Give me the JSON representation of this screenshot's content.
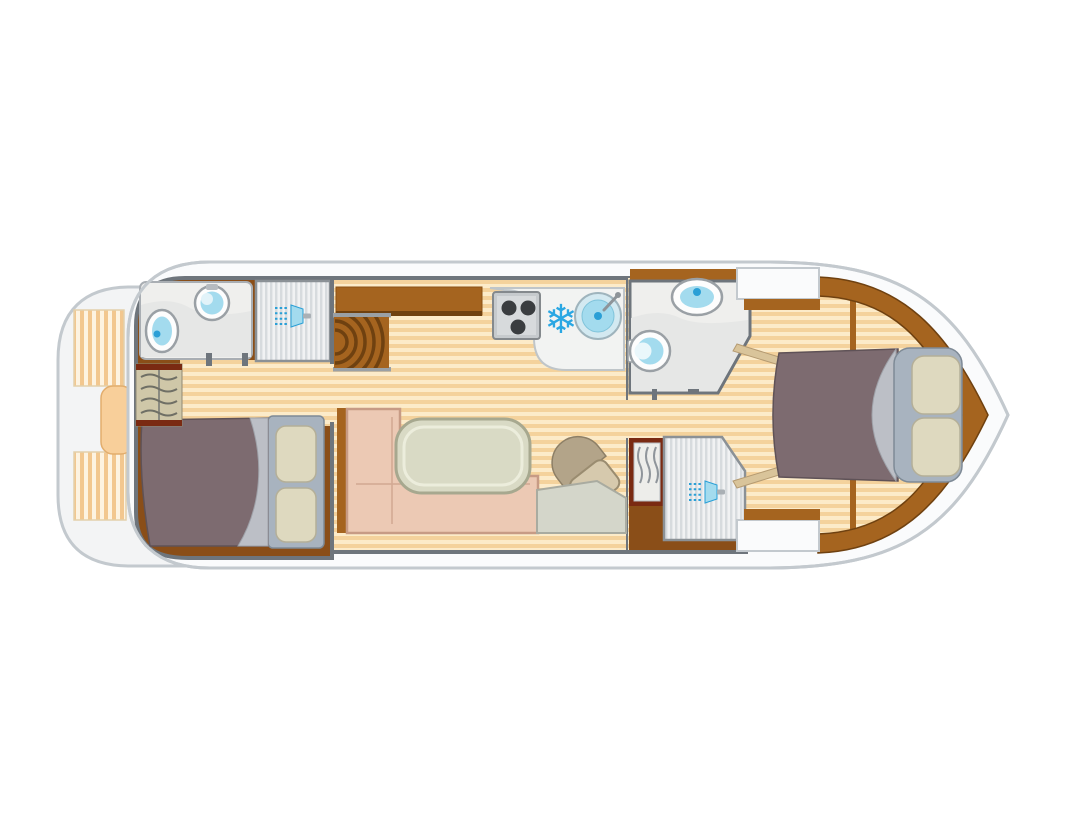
{
  "canvas": {
    "width": 1092,
    "height": 819,
    "background": "#ffffff"
  },
  "icons": {
    "fridge_glyph": "❄"
  },
  "colors": {
    "wall": "#6e757c",
    "hull_fill": "#fafbfc",
    "hull_stroke": "#c3c9ce",
    "deck_fill": "#f3f4f5",
    "floor_light": "#fcebc9",
    "floor_dark": "#f4d29c",
    "bench_light": "#fdf3e1",
    "bench_dark": "#f2c78f",
    "stern_table": "#f8cf9a",
    "wood": "#a5641f",
    "wood_dark": "#6f4110",
    "cabin_floor": "#8a4e18",
    "trim_red": "#7a2a12",
    "wardrobe": "#cfc7a8",
    "bath_floor": "#efefed",
    "bath_counter": "#e6e7e6",
    "shower_light": "#f1f2f3",
    "shower_dark": "#d7dbde",
    "fixture_blue": "#a3dbee",
    "fixture_blue_deep": "#2a9fd6",
    "snowflake_blue": "#2aa7e3",
    "stove_gray": "#c6cacd",
    "burner_dark": "#3a3d40",
    "counter": "#f2f3f2",
    "table": "#d9dac5",
    "table_edge": "#a7a88f",
    "sofa": "#ecc9b4",
    "sofa_edge": "#c79b85",
    "seat": "#d6c9ad",
    "seat_back": "#b3a489",
    "console": "#d4d6ca",
    "bed_blanket": "#7d6b70",
    "bed_fold": "#bcbfc6",
    "bed_base": "#a8b3bf",
    "pillow": "#ded9bf",
    "berth_trim": "#d9c49a"
  },
  "floor_plan": {
    "type": "boat-deck-plan",
    "areas": [
      {
        "name": "aft-deck",
        "features": [
          "bench-seat-port",
          "cockpit-table",
          "bench-seat-starboard"
        ]
      },
      {
        "name": "aft-cabin",
        "features": [
          "bathroom",
          "toilet",
          "washbasin",
          "shower",
          "wardrobe",
          "double-bed",
          "pillows"
        ]
      },
      {
        "name": "saloon",
        "features": [
          "companionway-stairs",
          "sideboard",
          "galley-counter",
          "stove",
          "fridge",
          "galley-sink",
          "dinette-table",
          "l-shaped-sofa",
          "helm-seat",
          "helm-console"
        ]
      },
      {
        "name": "mid-bathroom",
        "features": [
          "washbasin",
          "toilet"
        ]
      },
      {
        "name": "mid-shower-room",
        "features": [
          "wardrobe",
          "shower"
        ]
      },
      {
        "name": "bow-cabin",
        "features": [
          "double-bed",
          "pillows"
        ]
      }
    ]
  }
}
